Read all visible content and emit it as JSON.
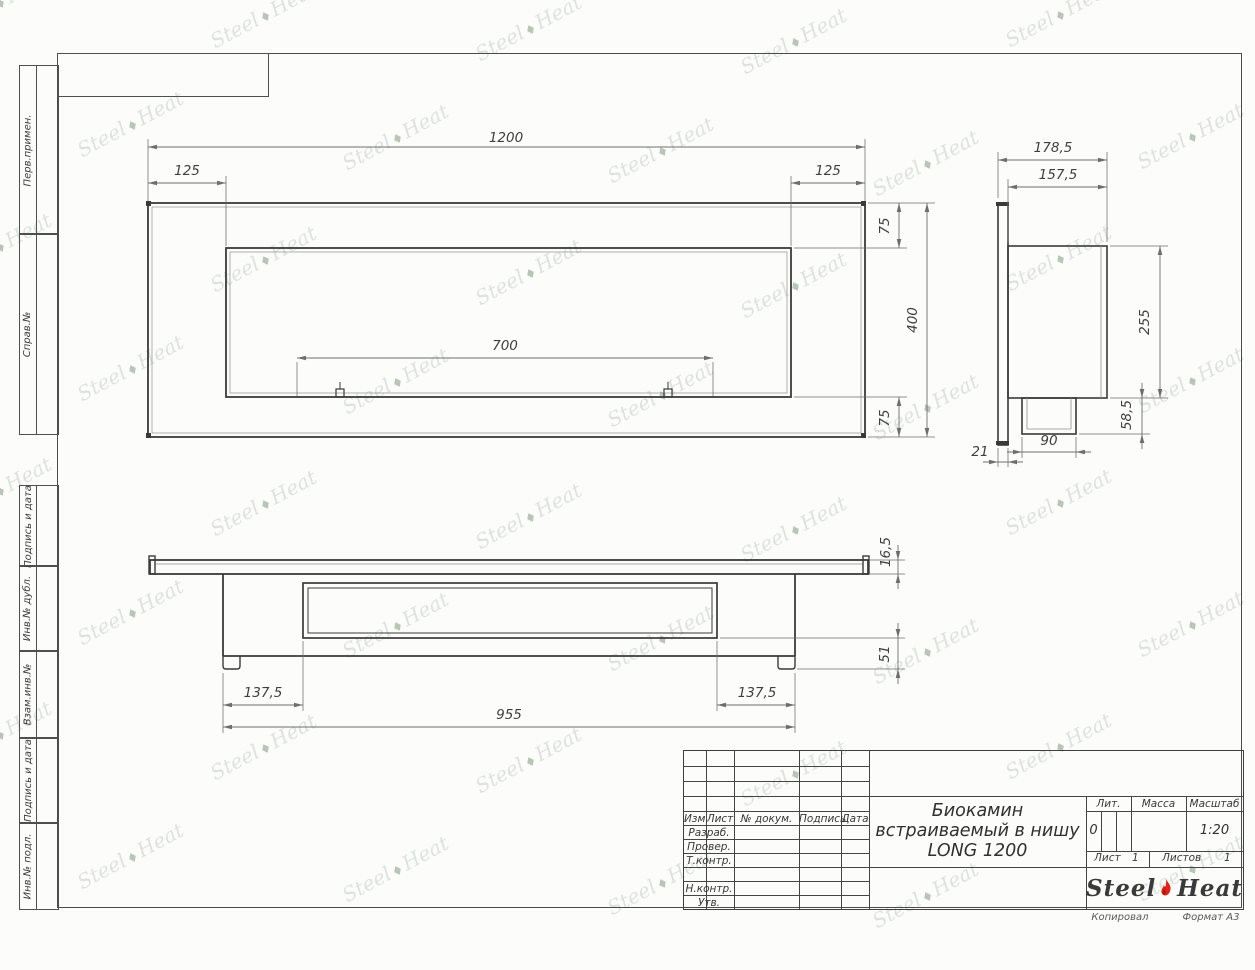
{
  "page": {
    "width": 1255,
    "height": 970
  },
  "watermark": {
    "word1": "Steel",
    "word2": "Heat",
    "separator": "♦"
  },
  "frame": {
    "sidebar": {
      "items": [
        {
          "label": "Перв.примен.",
          "top": 65,
          "height": 168
        },
        {
          "label": "Справ.№",
          "top": 233,
          "height": 200
        },
        {
          "label": "Подпись и дата",
          "top": 485,
          "height": 80
        },
        {
          "label": "Инв.№ дубл.",
          "top": 565,
          "height": 85
        },
        {
          "label": "Взам.инв.№",
          "top": 650,
          "height": 87
        },
        {
          "label": "Подпись и дата",
          "top": 737,
          "height": 85
        },
        {
          "label": "Инв.№ подл.",
          "top": 822,
          "height": 86
        }
      ]
    },
    "footer": {
      "copied": "Копировал",
      "format": "Формат А3"
    }
  },
  "title_block": {
    "rev_header": {
      "izm": "Изм.",
      "list": "Лист",
      "doc": "№ докум.",
      "sign": "Подпись",
      "date": "Дата"
    },
    "role_rows": [
      "Разраб.",
      "Провер.",
      "Т.контр.",
      "",
      "Н.контр.",
      "Утв."
    ],
    "title_lines": [
      "Биокамин",
      "встраиваемый в нишу",
      "LONG 1200"
    ],
    "lit": {
      "header": "Лит.",
      "value": "0"
    },
    "mass": {
      "header": "Масса",
      "value": ""
    },
    "scale": {
      "header": "Масштаб",
      "value": "1:20"
    },
    "sheet": {
      "label": "Лист",
      "value": "1"
    },
    "sheets": {
      "label": "Листов",
      "value": "1"
    },
    "logo": {
      "word1": "Steel",
      "word2": "Heat"
    }
  },
  "drawing": {
    "stroke_main": "#3a3a3a",
    "stroke_thin": "#8f8f8f",
    "stroke_dim": "#6e6e6e",
    "label_color": "#3f3f3f",
    "views": [
      {
        "id": "front-view",
        "shapes": [
          {
            "t": "rect",
            "x": 148,
            "y": 203,
            "w": 717,
            "h": 234,
            "sw": 1.8
          },
          {
            "t": "rect",
            "x": 152,
            "y": 207,
            "w": 709,
            "h": 226,
            "sw": 0.7,
            "thin": true
          },
          {
            "t": "rect",
            "x": 226,
            "y": 248,
            "w": 565,
            "h": 149,
            "sw": 1.8
          },
          {
            "t": "rect",
            "x": 230,
            "y": 252,
            "w": 557,
            "h": 141,
            "sw": 0.7,
            "thin": true
          },
          {
            "t": "fill",
            "x": 146,
            "y": 201,
            "w": 5,
            "h": 5
          },
          {
            "t": "fill",
            "x": 861,
            "y": 201,
            "w": 5,
            "h": 5
          },
          {
            "t": "fill",
            "x": 146,
            "y": 433,
            "w": 5,
            "h": 5
          },
          {
            "t": "fill",
            "x": 861,
            "y": 433,
            "w": 5,
            "h": 5
          },
          {
            "t": "rect",
            "x": 336,
            "y": 389,
            "w": 8,
            "h": 8,
            "sw": 1.2
          },
          {
            "t": "line",
            "x1": 340,
            "y1": 382,
            "x2": 340,
            "y2": 389,
            "sw": 1
          },
          {
            "t": "rect",
            "x": 664,
            "y": 389,
            "w": 8,
            "h": 8,
            "sw": 1.2
          },
          {
            "t": "line",
            "x1": 668,
            "y1": 382,
            "x2": 668,
            "y2": 389,
            "sw": 1
          }
        ],
        "dims": [
          {
            "label": "1200",
            "lx": 506,
            "ly": 142,
            "rot": 0,
            "ar": "in",
            "line": [
              148,
              147,
              865,
              147
            ],
            "ext": [
              [
                148,
                139,
                148,
                201
              ],
              [
                865,
                139,
                865,
                201
              ]
            ]
          },
          {
            "label": "125",
            "lx": 187,
            "ly": 175,
            "rot": 0,
            "ar": "in",
            "line": [
              148,
              183,
              226,
              183
            ],
            "ext": [
              [
                226,
                176,
                226,
                246
              ]
            ]
          },
          {
            "label": "125",
            "lx": 828,
            "ly": 175,
            "rot": 0,
            "ar": "in",
            "line": [
              791,
              183,
              865,
              183
            ],
            "ext": [
              [
                791,
                176,
                791,
                246
              ]
            ]
          },
          {
            "label": "75",
            "lx": 889,
            "ly": 226,
            "rot": -90,
            "ar": "in",
            "line": [
              899,
              203,
              899,
              248
            ],
            "ext": [
              [
                868,
                203,
                935,
                203
              ],
              [
                794,
                248,
                907,
                248
              ]
            ]
          },
          {
            "label": "400",
            "lx": 917,
            "ly": 320,
            "rot": -90,
            "ar": "in",
            "line": [
              927,
              203,
              927,
              437
            ],
            "ext": [
              [
                868,
                437,
                935,
                437
              ]
            ]
          },
          {
            "label": "75",
            "lx": 889,
            "ly": 418,
            "rot": -90,
            "ar": "in",
            "line": [
              899,
              397,
              899,
              437
            ],
            "ext": [
              [
                794,
                397,
                907,
                397
              ]
            ]
          },
          {
            "label": "700",
            "lx": 505,
            "ly": 350,
            "rot": 0,
            "ar": "in",
            "line": [
              297,
              358,
              713,
              358
            ],
            "ext": [
              [
                297,
                362,
                297,
                396
              ],
              [
                713,
                362,
                713,
                396
              ]
            ]
          }
        ]
      },
      {
        "id": "side-view",
        "shapes": [
          {
            "t": "rect",
            "x": 998,
            "y": 203,
            "w": 10,
            "h": 242,
            "sw": 1.6
          },
          {
            "t": "fill",
            "x": 996,
            "y": 202,
            "w": 13,
            "h": 4
          },
          {
            "t": "fill",
            "x": 996,
            "y": 441,
            "w": 13,
            "h": 4
          },
          {
            "t": "rect",
            "x": 1008,
            "y": 246,
            "w": 99,
            "h": 152,
            "sw": 1.6
          },
          {
            "t": "line",
            "x1": 1101,
            "y1": 246,
            "x2": 1101,
            "y2": 398,
            "sw": 0.8,
            "thin": true
          },
          {
            "t": "rect",
            "x": 1022,
            "y": 398,
            "w": 54,
            "h": 36,
            "sw": 1.6
          },
          {
            "t": "line",
            "x1": 1027,
            "y1": 398,
            "x2": 1027,
            "y2": 429,
            "sw": 0.8,
            "thin": true
          },
          {
            "t": "line",
            "x1": 1071,
            "y1": 398,
            "x2": 1071,
            "y2": 429,
            "sw": 0.8,
            "thin": true
          },
          {
            "t": "line",
            "x1": 1027,
            "y1": 429,
            "x2": 1071,
            "y2": 429,
            "sw": 0.8,
            "thin": true
          }
        ],
        "dims": [
          {
            "label": "178,5",
            "lx": 1053,
            "ly": 152,
            "rot": 0,
            "ar": "in",
            "line": [
              998,
              160,
              1107,
              160
            ],
            "ext": [
              [
                998,
                152,
                998,
                198
              ],
              [
                1107,
                152,
                1107,
                242
              ]
            ]
          },
          {
            "label": "157,5",
            "lx": 1058,
            "ly": 179,
            "rot": 0,
            "ar": "in",
            "line": [
              1008,
              187,
              1107,
              187
            ],
            "ext": [
              [
                1008,
                179,
                1008,
                242
              ]
            ]
          },
          {
            "label": "255",
            "lx": 1149,
            "ly": 322,
            "rot": -90,
            "ar": "in",
            "line": [
              1160,
              246,
              1160,
              398
            ],
            "ext": [
              [
                1110,
                246,
                1168,
                246
              ],
              [
                1110,
                398,
                1168,
                398
              ]
            ]
          },
          {
            "label": "58,5",
            "lx": 1131,
            "ly": 415,
            "rot": -90,
            "ar": "out",
            "line": [
              1142,
              398,
              1142,
              434
            ],
            "ext": [
              [
                1079,
                434,
                1150,
                434
              ]
            ]
          },
          {
            "label": "90",
            "lx": 1049,
            "ly": 445,
            "rot": 0,
            "ar": "out",
            "line": [
              1022,
              452,
              1076,
              452
            ],
            "ext": [
              [
                1022,
                437,
                1022,
                458
              ],
              [
                1076,
                437,
                1076,
                458
              ]
            ]
          },
          {
            "label": "21",
            "lx": 980,
            "ly": 456,
            "rot": 0,
            "ar": "out",
            "line": [
              998,
              462,
              1008,
              462
            ],
            "ext": [
              [
                998,
                448,
                998,
                467
              ],
              [
                1008,
                448,
                1008,
                467
              ]
            ]
          }
        ]
      },
      {
        "id": "bottom-view",
        "shapes": [
          {
            "t": "rect",
            "x": 150,
            "y": 560,
            "w": 718,
            "h": 14,
            "sw": 1.8
          },
          {
            "t": "line",
            "x1": 155,
            "y1": 564,
            "x2": 863,
            "y2": 564,
            "sw": 0.7,
            "thin": true
          },
          {
            "t": "rect",
            "x": 149,
            "y": 556,
            "w": 6,
            "h": 18,
            "sw": 1.4
          },
          {
            "t": "rect",
            "x": 863,
            "y": 556,
            "w": 6,
            "h": 18,
            "sw": 1.4
          },
          {
            "t": "line",
            "x1": 223,
            "y1": 574,
            "x2": 223,
            "y2": 656,
            "sw": 1.8
          },
          {
            "t": "line",
            "x1": 795,
            "y1": 574,
            "x2": 795,
            "y2": 656,
            "sw": 1.8
          },
          {
            "t": "line",
            "x1": 223,
            "y1": 656,
            "x2": 795,
            "y2": 656,
            "sw": 1.8
          },
          {
            "t": "path",
            "d": "M223,656 L223,666 Q223,669 226,669 L237,669 Q240,669 240,666 L240,656",
            "sw": 1.4
          },
          {
            "t": "path",
            "d": "M778,656 L778,666 Q778,669 781,669 L792,669 Q795,669 795,666 L795,656",
            "sw": 1.4
          },
          {
            "t": "rect",
            "x": 303,
            "y": 583,
            "w": 414,
            "h": 55,
            "sw": 1.7
          },
          {
            "t": "rect",
            "x": 308,
            "y": 588,
            "w": 404,
            "h": 45,
            "sw": 1.0
          }
        ],
        "dims": [
          {
            "label": "16,5",
            "lx": 890,
            "ly": 552,
            "rot": -90,
            "ar": "out",
            "line": [
              898,
              560,
              898,
              574
            ],
            "ext": [
              [
                870,
                560,
                905,
                560
              ],
              [
                870,
                574,
                905,
                574
              ]
            ]
          },
          {
            "label": "51",
            "lx": 889,
            "ly": 654,
            "rot": -90,
            "ar": "out",
            "line": [
              898,
              638,
              898,
              669
            ],
            "ext": [
              [
                720,
                638,
                905,
                638
              ],
              [
                797,
                669,
                905,
                669
              ]
            ]
          },
          {
            "label": "137,5",
            "lx": 263,
            "ly": 697,
            "rot": 0,
            "ar": "in",
            "line": [
              223,
              705,
              303,
              705
            ],
            "ext": [
              [
                223,
                673,
                223,
                711
              ],
              [
                303,
                641,
                303,
                711
              ]
            ]
          },
          {
            "label": "137,5",
            "lx": 757,
            "ly": 697,
            "rot": 0,
            "ar": "in",
            "line": [
              717,
              705,
              795,
              705
            ],
            "ext": [
              [
                717,
                641,
                717,
                711
              ],
              [
                795,
                673,
                795,
                711
              ]
            ]
          },
          {
            "label": "955",
            "lx": 509,
            "ly": 719,
            "rot": 0,
            "ar": "in",
            "line": [
              223,
              727,
              795,
              727
            ],
            "ext": [
              [
                223,
                711,
                223,
                733
              ],
              [
                795,
                711,
                795,
                733
              ]
            ]
          }
        ]
      }
    ]
  }
}
